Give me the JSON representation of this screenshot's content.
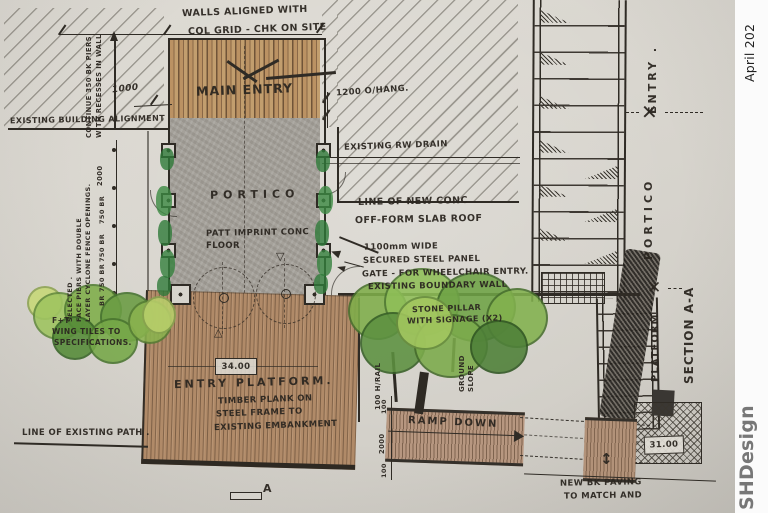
{
  "stamp": {
    "date": "April 202",
    "logo": "SHDesign"
  },
  "colors": {
    "paper": "#d9d6cf",
    "ink": "#2b2620",
    "hatch": "#68645b",
    "concrete": "#a6a29b",
    "timber_battens": "#bb9263",
    "platform_timber": "#b08a68",
    "ramp_timber": "#b79780",
    "green_light": "#9ec45f",
    "green_dark": "#4e8038",
    "logo_gray": "#6f6f6f"
  },
  "notes": {
    "walls_l1": "WALLS ALIGNED WITH",
    "walls_l2": "COL GRID - CHK ON SITE",
    "main_entry": "MAIN ENTRY",
    "overhang": "1200 O/HANG.",
    "building_alignment": "EXISTING BUILDING ALIGNMENT",
    "dim_1000": "1000",
    "cont_l1": "CONTINUE 350 BK PIERS",
    "cont_l2": "WITH RECESSES IN WALL",
    "sel_l1": "SELECTED .",
    "sel_l2": "FACE PIERS WITH DOUBLE",
    "sel_l3": "LAYER CYCLONE FENCE OPENINGS.",
    "portico": "PORTICO",
    "floor_l1": "PATT IMPRINT CONC",
    "floor_l2": "FLOOR",
    "rw_drain": "EXISTING RW DRAIN",
    "slab_l1": "LINE OF NEW CONC",
    "slab_l2": "OFF-FORM SLAB ROOF",
    "gate_l1": "1100mm WIDE",
    "gate_l2": "SECURED STEEL PANEL",
    "gate_l3": "GATE - FOR WHEELCHAIR ENTRY.",
    "boundary": "EXISTING BOUNDARY WALL",
    "pillar_l1": "STONE PILLAR",
    "pillar_l2": "WITH SIGNAGE (X2)",
    "plant_l1": "F+T",
    "plant_l2": "WING TILES TO",
    "plant_l3": "SPECIFICATIONS.",
    "level_platform": "34.00",
    "entry_platform": "ENTRY PLATFORM.",
    "plat_l1": "TIMBER PLANK ON",
    "plat_l2": "STEEL FRAME TO",
    "plat_l3": "EXISTING EMBANKMENT",
    "ramp_down": "RAMP DOWN",
    "path": "LINE OF EXISTING PATH .",
    "paving_l1": "NEW BK PAVING",
    "paving_l2": "TO MATCH AND",
    "level_ramp": "31.00",
    "hrail": "100 H/RAIL",
    "ground_l1": "GROUND",
    "ground_l2": "SLOPE",
    "dim100a": "100",
    "dim2000": "2000",
    "dim100b": "100"
  },
  "pier_dims": [
    "2000",
    "750 BR",
    "750 BR",
    "750 BR",
    "BR"
  ],
  "section_labels": {
    "entry": "ENTRY .",
    "portico": "PORTICO",
    "platform": "PLATFORM",
    "section": "SECTION A-A"
  },
  "markers": {
    "x": "✕",
    "tri_down": "▽",
    "tri_up": "△",
    "updown": "↕",
    "a": "A"
  }
}
